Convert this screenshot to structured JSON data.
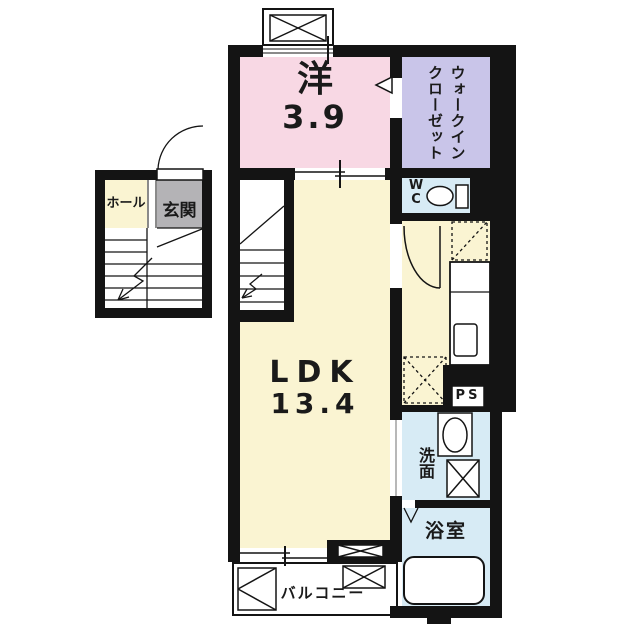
{
  "rooms": {
    "western_room": {
      "name": "洋",
      "area": "3.9"
    },
    "walk_in_closet": {
      "line1": "ウォークイン",
      "line2": "クローゼット"
    },
    "wc": {
      "line1": "W",
      "line2": "C"
    },
    "ldk": {
      "name": "LDK",
      "area": "13.4"
    },
    "washroom": {
      "name": "洗面"
    },
    "bathroom": {
      "name": "浴室"
    },
    "balcony": {
      "name": "バルコニー"
    },
    "hall": {
      "name": "ホール"
    },
    "entrance": {
      "name": "玄関"
    },
    "pipe_space": {
      "name": "PS"
    }
  },
  "colors": {
    "wall": "#141414",
    "western_room": "#f8d8e4",
    "walk_in_closet": "#c9c5e9",
    "ldk_hall": "#faf4d2",
    "wet_rooms": "#d7ebf5",
    "entrance": "#b4b3b6",
    "background": "#ffffff"
  }
}
